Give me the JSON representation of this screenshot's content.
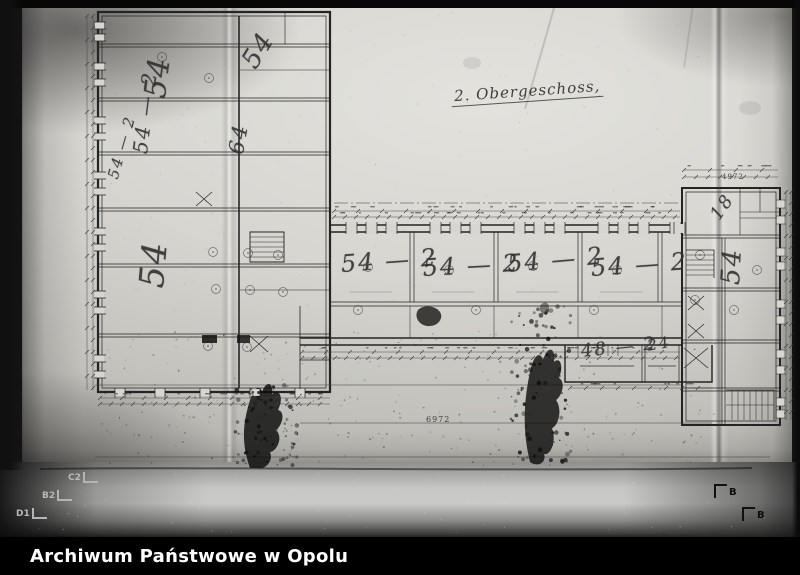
{
  "photo": {
    "caption_bar": {
      "text": "Archiwum Państwowe w Opolu",
      "bg": "#000000",
      "fg": "#ffffff"
    },
    "fiducials": {
      "left": [
        {
          "label": "C2",
          "x": 68,
          "y": 472
        },
        {
          "label": "B2",
          "x": 42,
          "y": 490
        },
        {
          "label": "D1",
          "x": 16,
          "y": 508
        }
      ],
      "right": [
        {
          "label": "B",
          "x": 714,
          "y": 484
        },
        {
          "label": "B",
          "x": 742,
          "y": 507
        }
      ]
    }
  },
  "drawing": {
    "title": {
      "text": "2. Obergeschoss,"
    },
    "room_labels": [
      {
        "text": "54",
        "x": 138,
        "y": 96,
        "rot": -83,
        "size": 30
      },
      {
        "text": "54",
        "x": 236,
        "y": 58,
        "rot": -58,
        "size": 26
      },
      {
        "text": "54 — 2",
        "x": 128,
        "y": 152,
        "rot": -83,
        "size": 20
      },
      {
        "text": "64",
        "x": 224,
        "y": 152,
        "rot": -80,
        "size": 21
      },
      {
        "text": "54",
        "x": 132,
        "y": 286,
        "rot": -85,
        "size": 34
      },
      {
        "text": "54 — 2",
        "x": 104,
        "y": 176,
        "rot": -74,
        "size": 15
      },
      {
        "text": "54 — 2",
        "x": 340,
        "y": 250,
        "rot": -4,
        "size": 24
      },
      {
        "text": "54 — 2",
        "x": 422,
        "y": 254,
        "rot": -3,
        "size": 24
      },
      {
        "text": "54 — 2",
        "x": 506,
        "y": 250,
        "rot": -5,
        "size": 24
      },
      {
        "text": "54 — 2",
        "x": 590,
        "y": 254,
        "rot": -4,
        "size": 24
      },
      {
        "text": "48 — 2",
        "x": 580,
        "y": 341,
        "rot": -6,
        "size": 18
      },
      {
        "text": "24",
        "x": 646,
        "y": 337,
        "rot": -10,
        "size": 15
      },
      {
        "text": "18",
        "x": 706,
        "y": 212,
        "rot": -55,
        "size": 18
      },
      {
        "text": "54",
        "x": 716,
        "y": 284,
        "rot": -87,
        "size": 26
      }
    ],
    "dimension_labels": [
      {
        "text": "6972",
        "x": 426,
        "y": 415,
        "size": 8
      },
      {
        "text": "4972",
        "x": 722,
        "y": 173,
        "size": 7
      }
    ],
    "colors": {
      "ink": "#2e2e2e",
      "pencil": "#3c3c3c",
      "paper": "#d6d5d0"
    }
  }
}
